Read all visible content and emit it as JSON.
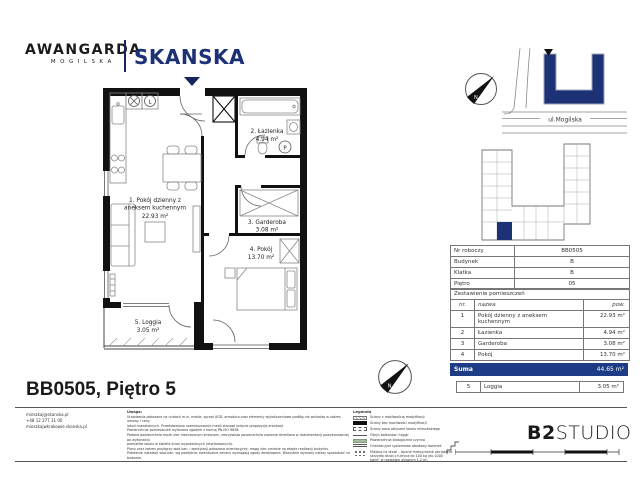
{
  "header": {
    "brand_line1": "AWANGARDA",
    "brand_line2": "MOGILSKA",
    "partner": "SKANSKA"
  },
  "colors": {
    "navy": "#1d3176",
    "wall_black": "#111111",
    "legend_green": "#a8bfa0"
  },
  "unit": {
    "title": "BB0505, Piętro 5"
  },
  "contact": {
    "email": "mieszkaj@skanska.pl",
    "phone": "+48 12 277 31 00",
    "website": "mieszkajwkrakowie.skanska.pl"
  },
  "plan": {
    "room1_l1": "1. Pokój dzienny z",
    "room1_l2": "aneksem kuchennym",
    "room1_area": "22.93 m²",
    "room2_name": "2. Łazienka",
    "room2_area": "4.94 m²",
    "room3_name": "3. Garderoba",
    "room3_area": "3.08 m²",
    "room4_name": "4. Pokój",
    "room4_area": "13.70 m²",
    "room5_name": "5. Loggia",
    "room5_area": "3.05 m²",
    "fridge_symbol": "L",
    "laundry_symbol": "P"
  },
  "map": {
    "street_label": "ul.Mogilska"
  },
  "compass": {
    "north_label": "N"
  },
  "info_table": {
    "rows": [
      {
        "label": "Nr roboczy",
        "value": "BB0505"
      },
      {
        "label": "Budynek",
        "value": "B"
      },
      {
        "label": "Klatka",
        "value": "B"
      },
      {
        "label": "Piętro",
        "value": "05"
      }
    ]
  },
  "rooms_table": {
    "title": "Zestawienie pomieszczeń",
    "col_nr": "nr.",
    "col_name": "nazwa",
    "col_area": "pow.",
    "rows": [
      {
        "nr": "1",
        "name": "Pokój dzienny z aneksem kuchennym",
        "area": "22.93 m²"
      },
      {
        "nr": "2",
        "name": "Łazienka",
        "area": "4.94 m²"
      },
      {
        "nr": "3",
        "name": "Garderoba",
        "area": "3.08 m²"
      },
      {
        "nr": "4",
        "name": "Pokój",
        "area": "13.70 m²"
      }
    ]
  },
  "summary": {
    "label": "Suma",
    "total": "44.65 m²",
    "loggia_nr": "5",
    "loggia_name": "Loggia",
    "loggia_area": "3.05 m²"
  },
  "notes": {
    "title": "Uwaga:",
    "lines": [
      "Urządzenia pokazane na rzutach m.in. meble, sprzęt AGD, armatura oraz elementy wykończeniowe podłóg nie wchodzą w zakres umowy i ceny",
      "lokali mieszkalnych. Przedstawione rozmieszczenie mebli stanowi jedynie propozycję aranżacji.",
      "Powierzchnia pomieszczeń wyliczona zgodnie z normą PN-ISO 9836.",
      "Podana powierzchnia może ulec nieznacznym zmianom, rzeczywista powierzchnia zostanie określona w dokumentacji powykonawczej po wykonaniu",
      "pomiarów lokalu w świetle ścian wyprawionych (otynkowanych).",
      "Piony oraz zakres przyłączy wod-kan. i wentylacji pokazano orientacyjnie, mogą ulec zmianie na etapie realizacji budynku.",
      "Położenie instalacji wod-kan. wg podejścia; ewentualne zmiany wymagają zgody dewelopera. Wszystkie wymiary należy sprawdzać na budowie."
    ]
  },
  "legend": {
    "title": "Legenda",
    "items": [
      {
        "label": "Ściany z możliwością modyfikacji"
      },
      {
        "label": "Ściany bez możliwości modyfikacji"
      },
      {
        "label": "Ściany poza obrysem lokalu mieszkalnego"
      },
      {
        "label": "Obrys balkonów i loggii"
      },
      {
        "label": "Powierzchnia biologicznie czynna"
      },
      {
        "label": "Orientacyjne systemowe obudowy łazienek"
      },
      {
        "label": "Miejsca na drzwi – łączne maksymalne obciążenie skrzydła drzwi z futryną do 100 kg (do 1000 kg/m² w rozstawie osiowym 1,2 m)"
      }
    ]
  },
  "studio": {
    "bold": "B2",
    "light": "STUDIO"
  }
}
